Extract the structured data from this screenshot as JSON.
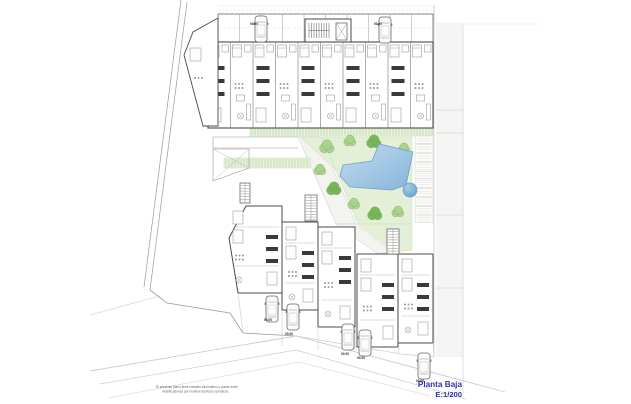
{
  "canvas": {
    "w": 631,
    "h": 404,
    "bg": "#ffffff"
  },
  "title_block": {
    "line1": "Planta Baja",
    "line2": "E:1/200",
    "color": "#2e34a0"
  },
  "disclaimer": {
    "line1": "El presente plano tiene carácter informativo y puede sufrir",
    "line2": "modificaciones por motivos técnicos y jurídicos.",
    "color": "#666666"
  },
  "level_label": {
    "text": "00.00",
    "positions": [
      [
        250,
        25
      ],
      [
        374,
        25
      ],
      [
        264,
        321
      ],
      [
        285,
        335
      ],
      [
        341,
        355
      ],
      [
        357,
        359
      ],
      [
        416,
        382
      ]
    ]
  },
  "colors": {
    "wall": "#4a4a4a",
    "dark": "#3a3a3a",
    "furn": "#8a8a8a",
    "furnFill": "#fdfdfd",
    "lineLight": "#cccccc",
    "lineMed": "#999999",
    "divider": "#777777",
    "lawn": "#e3efd7",
    "lawnStroke": "#cadfb8",
    "treeLight": "#a9d28e",
    "treeDark": "#74b356",
    "treeStroke": "#6fae52",
    "hatchFill": "#e7f2dc",
    "hatchLine": "#a3cc8d",
    "hatchStroke": "#c2dcb2",
    "poolLight": "#c3dcf0",
    "poolDeep": "#86b4db",
    "poolStroke": "#6f9fc6",
    "circleLight": "#a8cce6",
    "circleDeep": "#5e9dcc",
    "road": "#f5f5f3",
    "pathFill": "#f3f3f0",
    "label": "#2b2b2b"
  },
  "site": {
    "boundary": [
      [
        [
          181,
          0
        ],
        [
          144,
          287
        ]
      ],
      [
        [
          187,
          2
        ],
        [
          150,
          290
        ]
      ]
    ],
    "corner": [
      [
        150,
        290
      ],
      [
        167,
        303
      ],
      [
        230,
        313
      ],
      [
        243,
        333
      ],
      [
        296,
        336
      ]
    ],
    "plot_edge": [
      [
        296,
        336
      ],
      [
        401,
        354
      ],
      [
        434,
        357
      ]
    ],
    "streets": [
      {
        "pts": [
          [
            90,
            371
          ],
          [
            296,
            336
          ],
          [
            505,
            392
          ]
        ],
        "w": 0.9
      },
      {
        "pts": [
          [
            100,
            384
          ],
          [
            296,
            350
          ],
          [
            466,
            399
          ]
        ],
        "w": 0.7
      },
      {
        "pts": [
          [
            160,
            296
          ],
          [
            90,
            315
          ]
        ],
        "w": 0.6
      },
      {
        "pts": [
          [
            108,
            398
          ],
          [
            299,
            362
          ],
          [
            430,
            396
          ]
        ],
        "w": 0.5
      }
    ],
    "right_strip": {
      "x": 436,
      "y": 25,
      "w": 27,
      "h": 332,
      "edge_x": 434,
      "outer_x": 463,
      "hlines": [
        24,
        110,
        133,
        215,
        288
      ],
      "top_line_x2": 540
    },
    "walkway": [
      [
        [
          213,
          137
        ],
        [
          298,
          137
        ]
      ],
      [
        [
          213,
          148
        ],
        [
          298,
          148
        ]
      ],
      [
        [
          213,
          137
        ],
        [
          213,
          148
        ]
      ]
    ],
    "paths": [
      [
        [
          298,
          137
        ],
        [
          320,
          137
        ],
        [
          356,
          224
        ],
        [
          336,
          224
        ]
      ],
      [
        [
          336,
          224
        ],
        [
          356,
          224
        ],
        [
          392,
          252
        ],
        [
          378,
          254
        ]
      ]
    ]
  },
  "landscape": {
    "lawns": [
      [
        [
          322,
          137
        ],
        [
          412,
          137
        ],
        [
          412,
          224
        ],
        [
          358,
          224
        ]
      ],
      [
        [
          300,
          137
        ],
        [
          322,
          137
        ],
        [
          336,
          170
        ]
      ],
      [
        [
          358,
          224
        ],
        [
          412,
          224
        ],
        [
          412,
          250
        ],
        [
          394,
          252
        ]
      ]
    ],
    "hatch_strips": [
      {
        "x": 250,
        "y": 127,
        "w": 183,
        "h": 9
      },
      {
        "x": 224,
        "y": 158,
        "w": 86,
        "h": 10
      }
    ],
    "pergola": {
      "x": 415,
      "y": 136,
      "w": 18,
      "h": 88,
      "cells": 10
    },
    "trees": [
      {
        "x": 327,
        "y": 147,
        "r": 6,
        "t": "light"
      },
      {
        "x": 350,
        "y": 141,
        "r": 5,
        "t": "light"
      },
      {
        "x": 374,
        "y": 142,
        "r": 6,
        "t": "dark"
      },
      {
        "x": 404,
        "y": 149,
        "r": 5,
        "t": "light"
      },
      {
        "x": 320,
        "y": 170,
        "r": 5,
        "t": "light"
      },
      {
        "x": 334,
        "y": 189,
        "r": 6,
        "t": "dark"
      },
      {
        "x": 354,
        "y": 204,
        "r": 5,
        "t": "light"
      },
      {
        "x": 375,
        "y": 214,
        "r": 6,
        "t": "dark"
      },
      {
        "x": 398,
        "y": 212,
        "r": 5,
        "t": "light"
      }
    ]
  },
  "pool": {
    "main": [
      [
        379,
        144
      ],
      [
        413,
        152
      ],
      [
        406,
        185
      ],
      [
        392,
        190
      ],
      [
        350,
        187
      ],
      [
        340,
        176
      ],
      [
        343,
        165
      ],
      [
        372,
        161
      ]
    ],
    "circle": {
      "cx": 410,
      "cy": 190,
      "r": 7
    }
  },
  "buildings": {
    "roof_lines": {
      "y_solid": 6,
      "y_dash": 10,
      "x0": 218,
      "x1": 433
    },
    "top_block": {
      "x0": 208,
      "y0": 42,
      "x1": 433,
      "y1": 128,
      "bays": 10
    },
    "garage_row": {
      "x0": 218,
      "y0": 14,
      "x1": 433,
      "y1": 42,
      "bays": 10
    },
    "stair_core": {
      "x": 305,
      "y": 19,
      "w": 46,
      "h": 27
    },
    "left_wing": [
      [
        218,
        18
      ],
      [
        193,
        32
      ],
      [
        184,
        55
      ],
      [
        203,
        126
      ],
      [
        218,
        126
      ]
    ],
    "cross_box": [
      [
        213,
        149
      ],
      [
        249,
        149
      ],
      [
        249,
        168
      ],
      [
        213,
        181
      ]
    ],
    "bottom_units": [
      [
        [
          246,
          206
        ],
        [
          282,
          206
        ],
        [
          282,
          293
        ],
        [
          238,
          293
        ],
        [
          229,
          238
        ]
      ],
      [
        [
          282,
          222
        ],
        [
          318,
          222
        ],
        [
          318,
          310
        ],
        [
          282,
          310
        ]
      ],
      [
        [
          318,
          227
        ],
        [
          355,
          227
        ],
        [
          355,
          327
        ],
        [
          318,
          327
        ]
      ],
      [
        [
          357,
          254
        ],
        [
          398,
          254
        ],
        [
          398,
          347
        ],
        [
          357,
          347
        ]
      ],
      [
        [
          398,
          254
        ],
        [
          433,
          254
        ],
        [
          433,
          343
        ],
        [
          398,
          343
        ]
      ]
    ],
    "stairs": [
      {
        "x": 240,
        "y": 183,
        "w": 10,
        "h": 20
      },
      {
        "x": 305,
        "y": 195,
        "w": 12,
        "h": 26
      },
      {
        "x": 387,
        "y": 229,
        "w": 12,
        "h": 25
      }
    ],
    "driveway_lines": [
      [
        [
          282,
          310
        ],
        [
          282,
          346
        ]
      ],
      [
        [
          318,
          327
        ],
        [
          318,
          350
        ]
      ],
      [
        [
          355,
          327
        ],
        [
          355,
          352
        ]
      ],
      [
        [
          398,
          347
        ],
        [
          399,
          354
        ]
      ],
      [
        [
          433,
          343
        ],
        [
          434,
          357
        ]
      ],
      [
        [
          238,
          293
        ],
        [
          243,
          333
        ]
      ]
    ]
  },
  "cars": {
    "size": {
      "w": 12,
      "h": 26
    },
    "items": [
      {
        "x": 255,
        "y": 16
      },
      {
        "x": 379,
        "y": 17
      },
      {
        "x": 266,
        "y": 296
      },
      {
        "x": 287,
        "y": 304
      },
      {
        "x": 342,
        "y": 324
      },
      {
        "x": 359,
        "y": 330
      },
      {
        "x": 418,
        "y": 353
      }
    ]
  }
}
